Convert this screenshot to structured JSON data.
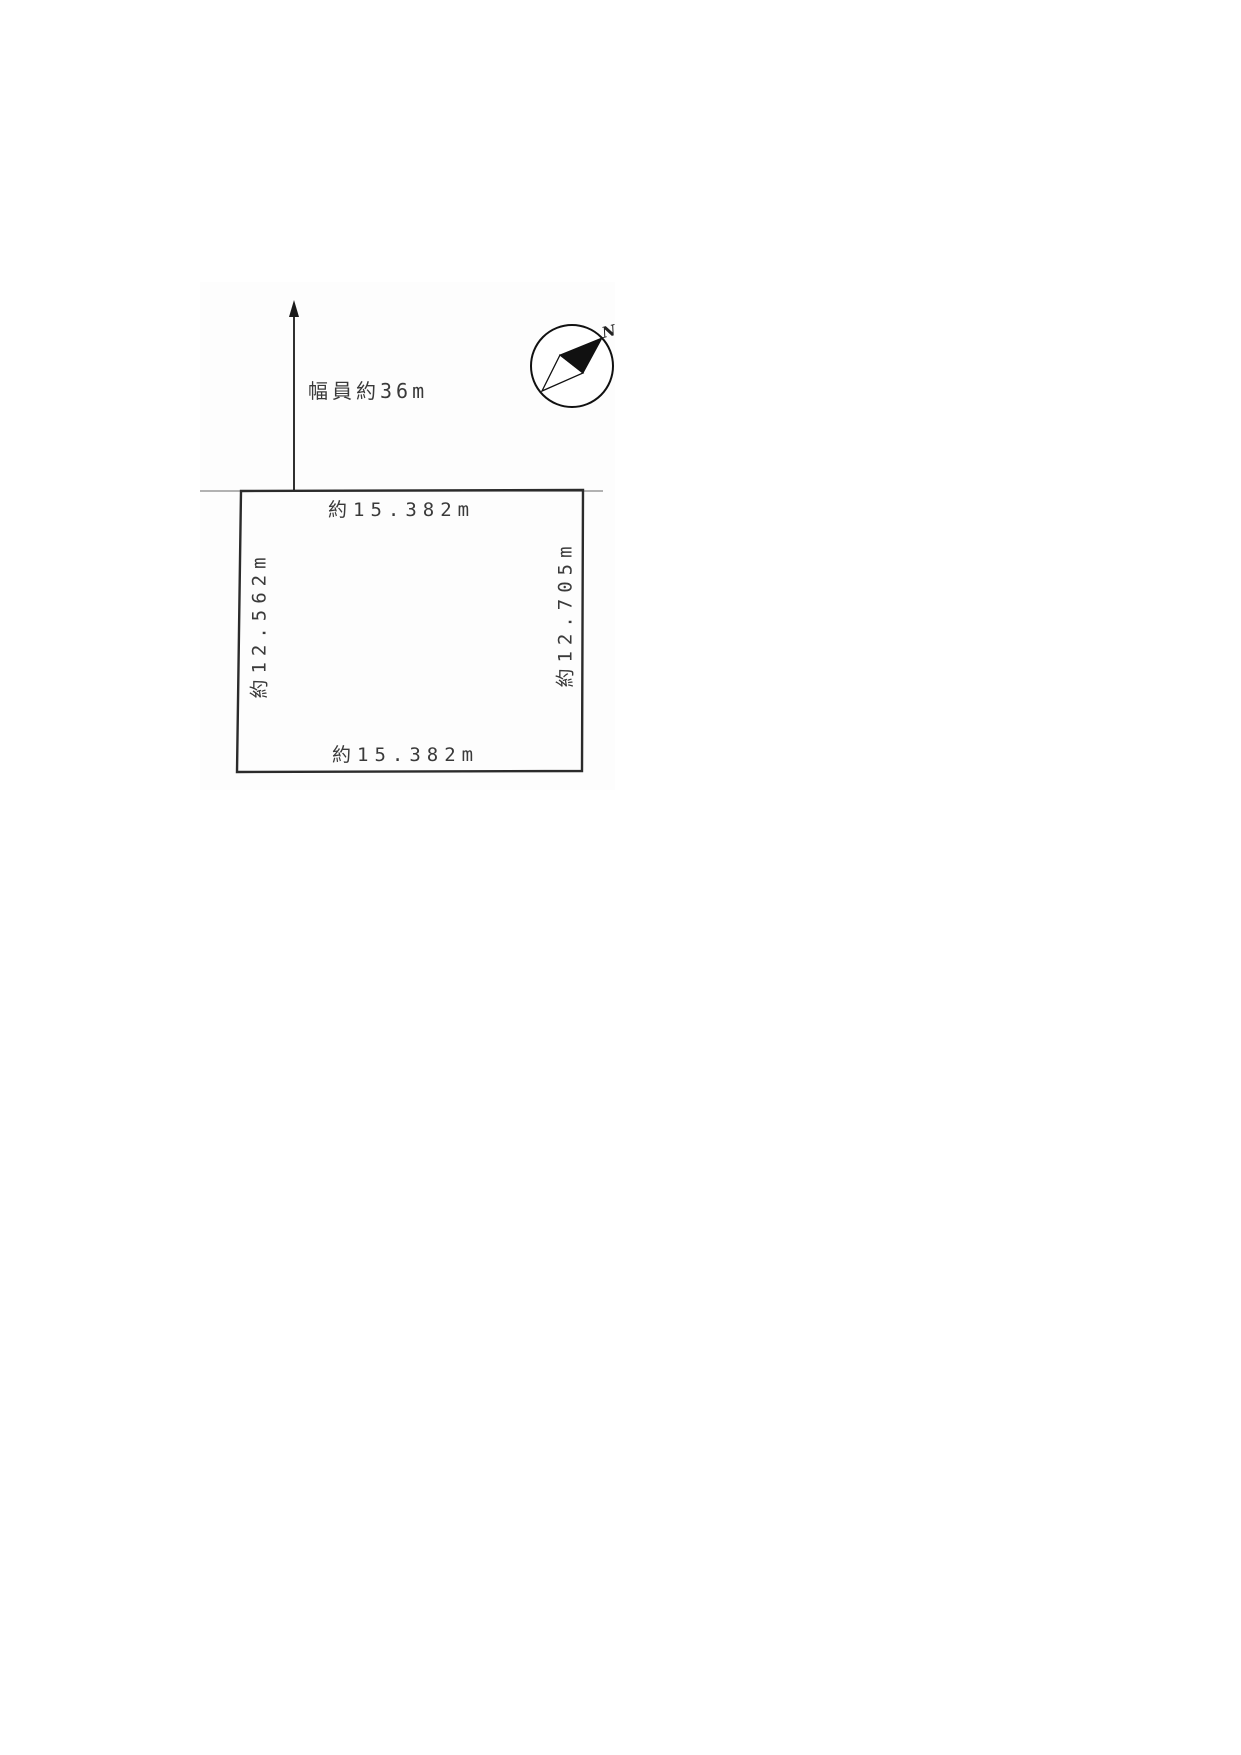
{
  "page": {
    "background": "#ffffff",
    "type": "land-plot-survey-diagram"
  },
  "drawing": {
    "road": {
      "width_label": "幅員約36m",
      "arrow_icon": "road-direction-up-arrow"
    },
    "compass": {
      "icon": "compass-north-needle",
      "north_label": "N"
    },
    "plot": {
      "top_dimension": "約15.382m",
      "bottom_dimension": "約15.382m",
      "left_dimension": "約12.562m",
      "right_dimension": "約12.705m"
    },
    "colors": {
      "boundary_line": "#2b2b2b",
      "road_line": "#999999",
      "arrow": "#1a1a1a",
      "compass_fill": "#111111",
      "text": "#3a3a3a"
    }
  }
}
